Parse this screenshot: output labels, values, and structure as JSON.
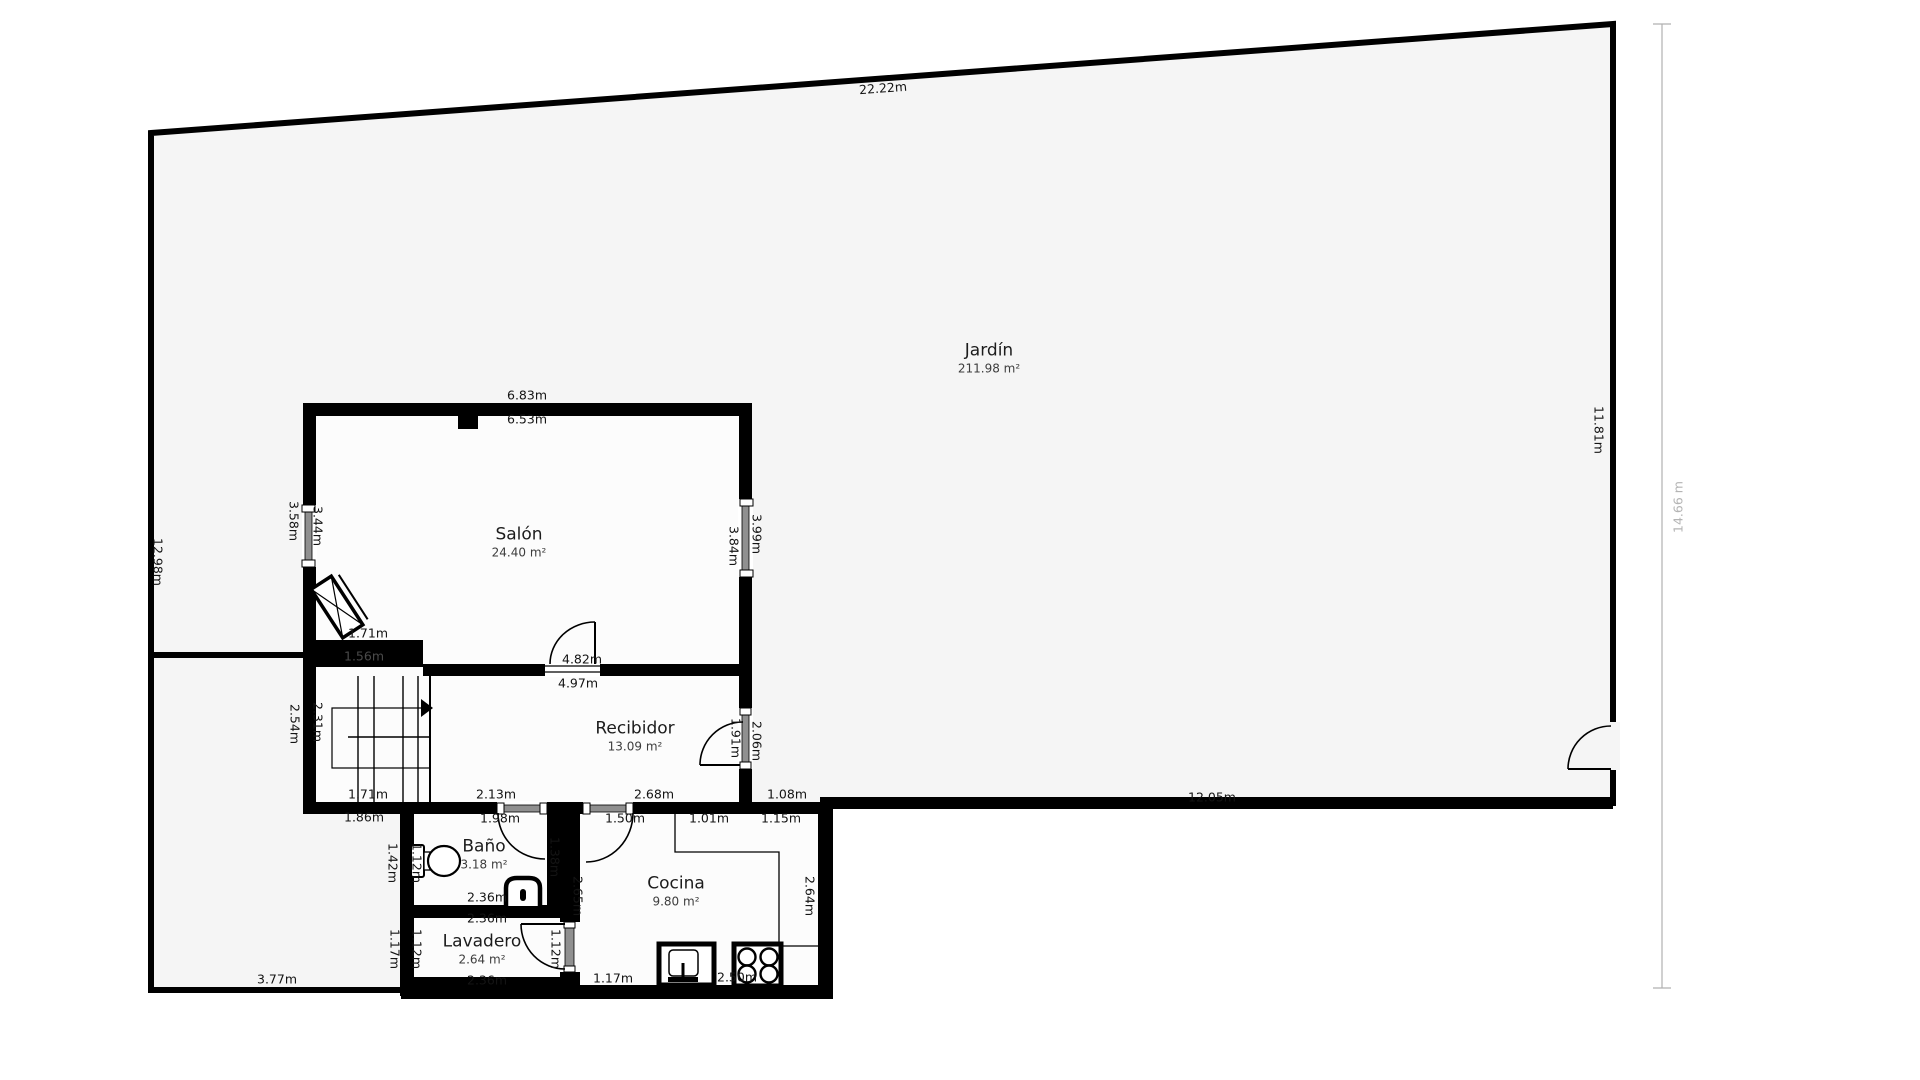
{
  "plan": {
    "colors": {
      "wall": "#000000",
      "garden_fill": "#f5f5f5",
      "floor_fill": "#fcfcfc",
      "window_glass": "#909090",
      "dim_line": "#b0b0b0",
      "muted_label": "#b4b4b4",
      "dark_on_wall_label": "#4a4a4a"
    },
    "rooms": [
      {
        "id": "jardin",
        "name": "Jardín",
        "area": "211.98 m²",
        "x": 989,
        "y": 359
      },
      {
        "id": "salon",
        "name": "Salón",
        "area": "24.40 m²",
        "x": 519,
        "y": 543
      },
      {
        "id": "recibidor",
        "name": "Recibidor",
        "area": "13.09 m²",
        "x": 635,
        "y": 737
      },
      {
        "id": "bano",
        "name": "Baño",
        "area": "3.18 m²",
        "x": 484,
        "y": 855
      },
      {
        "id": "cocina",
        "name": "Cocina",
        "area": "9.80 m²",
        "x": 676,
        "y": 892
      },
      {
        "id": "lavadero",
        "name": "Lavadero",
        "area": "2.64 m²",
        "x": 482,
        "y": 950
      }
    ],
    "dims": [
      {
        "t": "22.22m",
        "x": 883,
        "y": 88,
        "r": -4.2
      },
      {
        "t": "12.98m",
        "x": 158,
        "y": 562,
        "r": 90
      },
      {
        "t": "11.81m",
        "x": 1599,
        "y": 430,
        "r": 90
      },
      {
        "t": "14.66 m",
        "x": 1678,
        "y": 507,
        "r": -90,
        "c": "#b4b4b4"
      },
      {
        "t": "12.05m",
        "x": 1212,
        "y": 797,
        "r": 0
      },
      {
        "t": "3.77m",
        "x": 277,
        "y": 979,
        "r": 0
      },
      {
        "t": "6.83m",
        "x": 527,
        "y": 395,
        "r": 0
      },
      {
        "t": "6.53m",
        "x": 527,
        "y": 419,
        "r": 0
      },
      {
        "t": "3.58m",
        "x": 294,
        "y": 521,
        "r": 90
      },
      {
        "t": "3.44m",
        "x": 318,
        "y": 526,
        "r": 90
      },
      {
        "t": "3.84m",
        "x": 734,
        "y": 546,
        "r": 90
      },
      {
        "t": "3.99m",
        "x": 757,
        "y": 534,
        "r": 90
      },
      {
        "t": "1.71m",
        "x": 368,
        "y": 633,
        "r": 0
      },
      {
        "t": "1.56m",
        "x": 364,
        "y": 656,
        "r": 0,
        "c": "#4a4a4a"
      },
      {
        "t": "2.54m",
        "x": 295,
        "y": 724,
        "r": 90
      },
      {
        "t": "2.31m",
        "x": 318,
        "y": 722,
        "r": 90
      },
      {
        "t": "1.71m",
        "x": 368,
        "y": 794,
        "r": 0
      },
      {
        "t": "1.86m",
        "x": 364,
        "y": 817,
        "r": 0
      },
      {
        "t": "4.82m",
        "x": 582,
        "y": 659,
        "r": 0
      },
      {
        "t": "4.97m",
        "x": 578,
        "y": 683,
        "r": 0
      },
      {
        "t": "1.91m",
        "x": 736,
        "y": 738,
        "r": 90
      },
      {
        "t": "2.06m",
        "x": 757,
        "y": 741,
        "r": 90
      },
      {
        "t": "2.13m",
        "x": 496,
        "y": 794,
        "r": 0
      },
      {
        "t": "2.68m",
        "x": 654,
        "y": 794,
        "r": 0
      },
      {
        "t": "1.08m",
        "x": 787,
        "y": 794,
        "r": 0
      },
      {
        "t": "1.98m",
        "x": 500,
        "y": 818,
        "r": 0
      },
      {
        "t": "1.50m",
        "x": 625,
        "y": 818,
        "r": 0
      },
      {
        "t": "1.01m",
        "x": 709,
        "y": 818,
        "r": 0
      },
      {
        "t": "1.15m",
        "x": 781,
        "y": 818,
        "r": 0
      },
      {
        "t": "1.42m",
        "x": 393,
        "y": 863,
        "r": 90
      },
      {
        "t": "1.12m",
        "x": 417,
        "y": 863,
        "r": 90
      },
      {
        "t": "1.38m",
        "x": 555,
        "y": 857,
        "r": 90
      },
      {
        "t": "2.36m",
        "x": 487,
        "y": 897,
        "r": 0
      },
      {
        "t": "2.36m",
        "x": 487,
        "y": 918,
        "r": 0
      },
      {
        "t": "2.65m",
        "x": 578,
        "y": 896,
        "r": 90
      },
      {
        "t": "2.64m",
        "x": 810,
        "y": 896,
        "r": 90
      },
      {
        "t": "1.17m",
        "x": 395,
        "y": 949,
        "r": 90
      },
      {
        "t": "1.12m",
        "x": 417,
        "y": 949,
        "r": 90
      },
      {
        "t": "1.12m",
        "x": 556,
        "y": 949,
        "r": 90
      },
      {
        "t": "2.36m",
        "x": 487,
        "y": 980,
        "r": 0
      },
      {
        "t": "1.17m",
        "x": 613,
        "y": 978,
        "r": 0
      },
      {
        "t": "2.50m",
        "x": 737,
        "y": 977,
        "r": 0
      }
    ]
  }
}
